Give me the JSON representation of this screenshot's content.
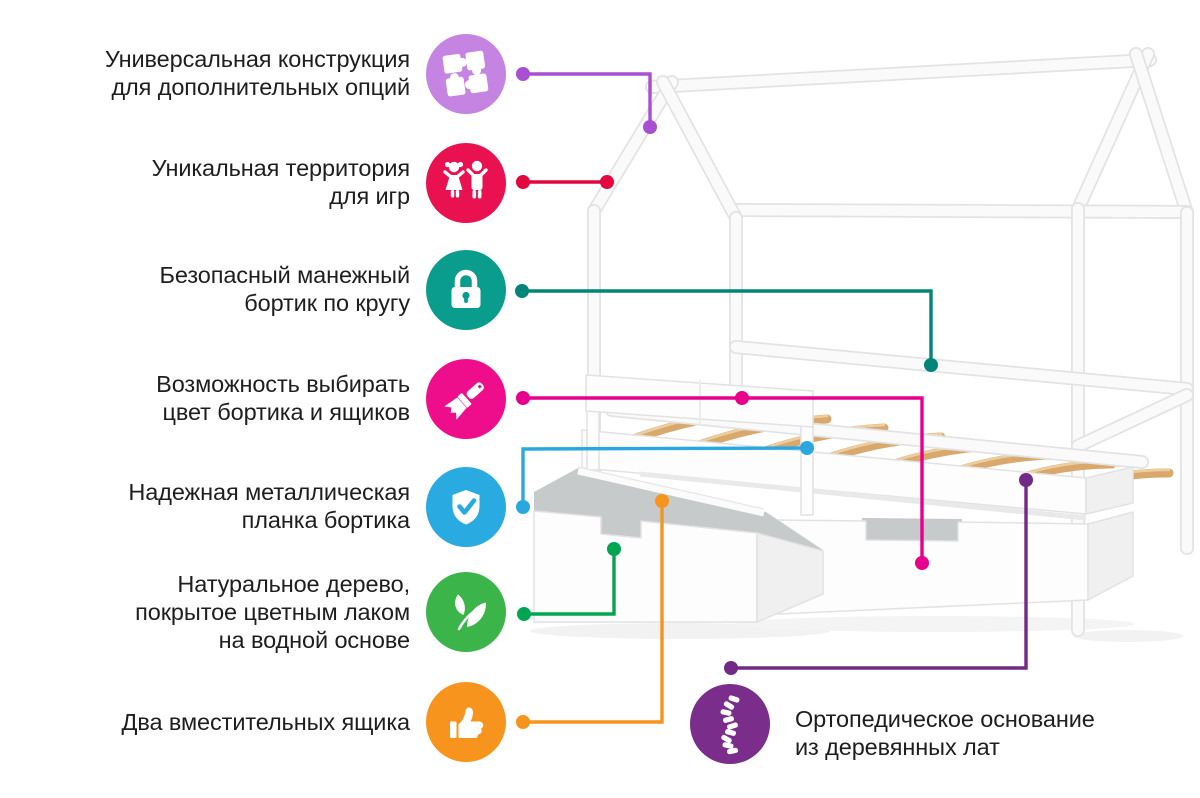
{
  "background_color": "#ffffff",
  "subject": "house-frame-kids-bed-infographic",
  "features": [
    {
      "id": "universal-construction",
      "label_lines": [
        "Универсальная конструкция",
        "для дополнительных опций"
      ],
      "icon": "puzzle-icon",
      "circle_color": "#c584e2",
      "line_color": "#a94fd2",
      "connector": {
        "points": [
          [
            523,
            74
          ],
          [
            650,
            74
          ],
          [
            650,
            127
          ]
        ],
        "dots": [
          [
            523,
            74
          ],
          [
            650,
            127
          ]
        ]
      }
    },
    {
      "id": "play-territory",
      "label_lines": [
        "Уникальная территория",
        "для игр"
      ],
      "icon": "children-icon",
      "circle_color": "#ea1150",
      "line_color": "#e4063f",
      "connector": {
        "points": [
          [
            523,
            182
          ],
          [
            607,
            182
          ]
        ],
        "dots": [
          [
            523,
            182
          ],
          [
            607,
            182
          ]
        ]
      }
    },
    {
      "id": "safety-rail-perimeter",
      "label_lines": [
        "Безопасный манежный",
        "бортик по кругу"
      ],
      "icon": "padlock-icon",
      "circle_color": "#0a9d8e",
      "line_color": "#00857b",
      "connector": {
        "points": [
          [
            522,
            291
          ],
          [
            931,
            291
          ],
          [
            931,
            365
          ]
        ],
        "dots": [
          [
            522,
            291
          ],
          [
            931,
            365
          ]
        ]
      }
    },
    {
      "id": "color-choice",
      "label_lines": [
        "Возможность выбирать",
        "цвет бортика и ящиков"
      ],
      "icon": "paintbrush-icon",
      "circle_color": "#ee0e8c",
      "line_color": "#e6008b",
      "connector": {
        "points": [
          [
            523,
            398
          ],
          [
            922,
            398
          ],
          [
            922,
            563
          ]
        ],
        "dots": [
          [
            523,
            398
          ],
          [
            742,
            398
          ],
          [
            922,
            563
          ]
        ]
      }
    },
    {
      "id": "metal-plank",
      "label_lines": [
        "Надежная металлическая",
        "планка бортика"
      ],
      "icon": "shield-check-icon",
      "circle_color": "#29abe2",
      "line_color": "#29a8e0",
      "connector": {
        "points": [
          [
            523,
            507
          ],
          [
            523,
            449
          ],
          [
            807,
            448
          ]
        ],
        "dots": [
          [
            523,
            507
          ],
          [
            807,
            448
          ]
        ]
      }
    },
    {
      "id": "natural-wood",
      "label_lines": [
        "Натуральное дерево,",
        "покрытое цветным лаком",
        "на водной основе"
      ],
      "icon": "leaf-icon",
      "circle_color": "#3bb54a",
      "line_color": "#00a651",
      "connector": {
        "points": [
          [
            524,
            614
          ],
          [
            614,
            614
          ],
          [
            614,
            549
          ]
        ],
        "dots": [
          [
            524,
            614
          ],
          [
            614,
            549
          ]
        ]
      }
    },
    {
      "id": "two-drawers",
      "label_lines": [
        "Два вместительных ящика"
      ],
      "icon": "thumbs-up-icon",
      "circle_color": "#f7941d",
      "line_color": "#f7941d",
      "connector": {
        "points": [
          [
            523,
            722
          ],
          [
            662,
            722
          ],
          [
            662,
            501
          ]
        ],
        "dots": [
          [
            523,
            722
          ],
          [
            662,
            501
          ]
        ]
      }
    },
    {
      "id": "orthopedic-base",
      "label_lines": [
        "Ортопедическое основание",
        "из деревянных лат"
      ],
      "icon": "spine-icon",
      "circle_color": "#7b2d8b",
      "line_color": "#722a84",
      "connector": {
        "points": [
          [
            731,
            668
          ],
          [
            1026,
            668
          ],
          [
            1026,
            480
          ]
        ],
        "dots": [
          [
            731,
            668
          ],
          [
            1026,
            480
          ]
        ]
      }
    }
  ]
}
